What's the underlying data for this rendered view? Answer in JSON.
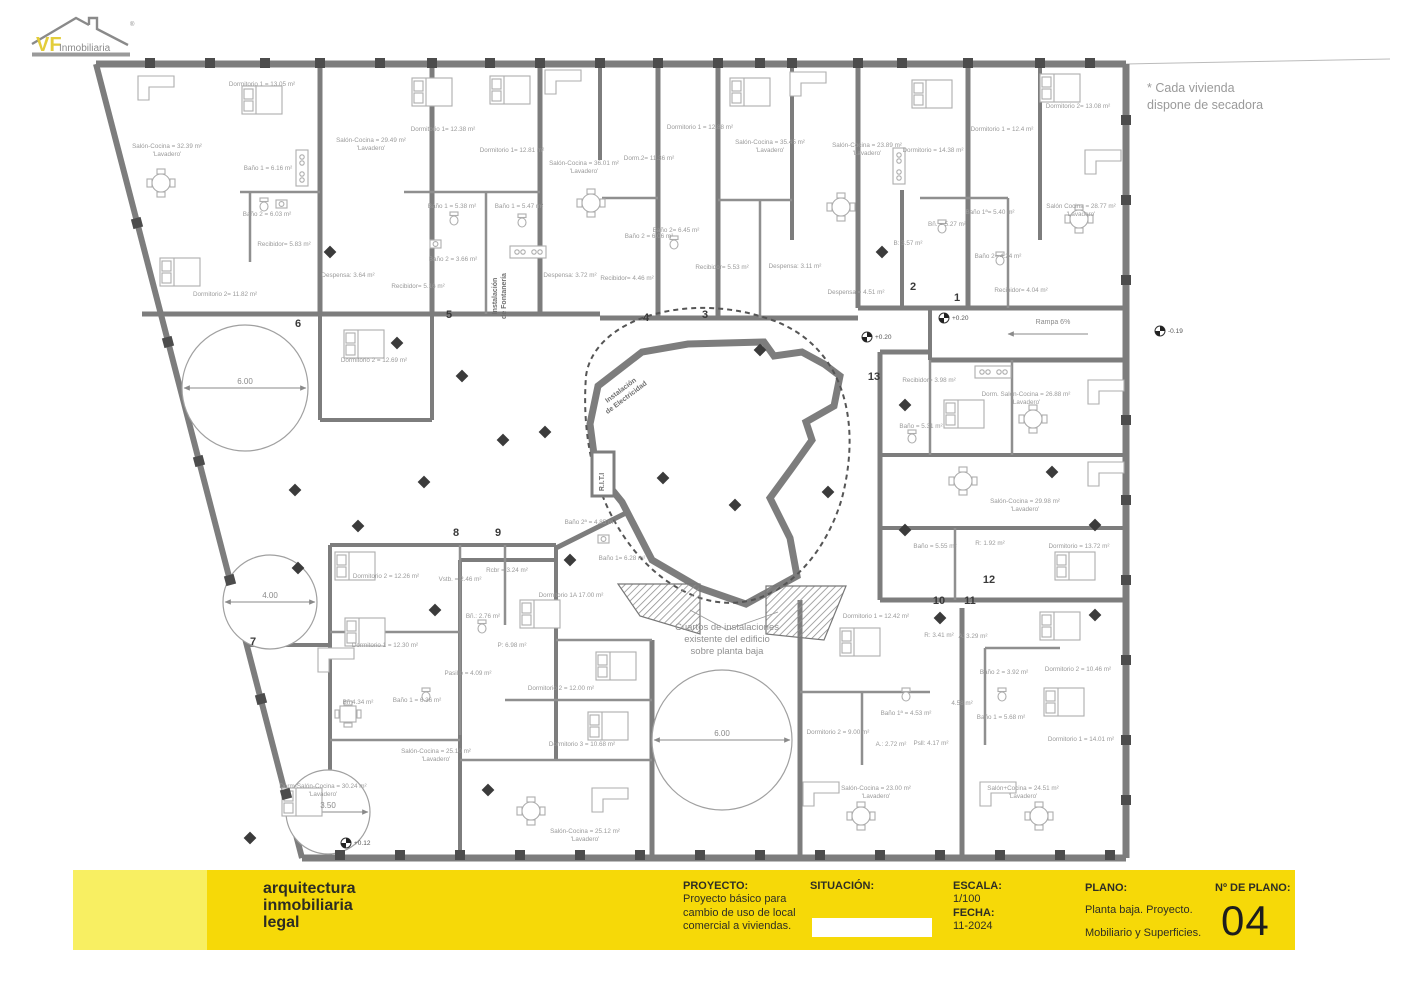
{
  "logo": {
    "vf": "VF",
    "rest": "Inmobiliaria",
    "reg": "®"
  },
  "note": {
    "line1": "* Cada vivienda",
    "line2": "dispone de secadora"
  },
  "title_block": {
    "company_lines": [
      "arquitectura",
      "inmobiliaria",
      "legal"
    ],
    "proyecto_label": "PROYECTO:",
    "proyecto_lines": [
      "Proyecto básico para",
      "cambio de uso de local",
      "comercial a viviendas."
    ],
    "situacion_label": "SITUACIÓN:",
    "escala_label": "ESCALA:",
    "escala_value": "1/100",
    "fecha_label": "FECHA:",
    "fecha_value": "11-2024",
    "plano_label": "PLANO:",
    "plano_lines": [
      "Planta baja. Proyecto.",
      "Mobiliario y Superficies."
    ],
    "num_label": "Nº DE PLANO:",
    "num_value": "04"
  },
  "plan": {
    "unit_numbers": [
      {
        "n": "6",
        "x": 298,
        "y": 327
      },
      {
        "n": "5",
        "x": 449,
        "y": 318
      },
      {
        "n": "4",
        "x": 646,
        "y": 321
      },
      {
        "n": "3",
        "x": 705,
        "y": 318
      },
      {
        "n": "2",
        "x": 913,
        "y": 290
      },
      {
        "n": "1",
        "x": 957,
        "y": 301
      },
      {
        "n": "13",
        "x": 874,
        "y": 380
      },
      {
        "n": "8",
        "x": 456,
        "y": 536
      },
      {
        "n": "9",
        "x": 498,
        "y": 536
      },
      {
        "n": "7",
        "x": 253,
        "y": 645
      },
      {
        "n": "10",
        "x": 939,
        "y": 604
      },
      {
        "n": "11",
        "x": 970,
        "y": 604
      },
      {
        "n": "12",
        "x": 989,
        "y": 583
      }
    ],
    "room_labels": [
      {
        "t": "Dormitorio 1 = 13.05 m²",
        "x": 262,
        "y": 86
      },
      {
        "t": "Salón-Cocina = 32.39 m²",
        "x": 167,
        "y": 148
      },
      {
        "t": "'Lavadero'",
        "x": 167,
        "y": 156
      },
      {
        "t": "Baño 1 = 6.16 m²",
        "x": 268,
        "y": 170
      },
      {
        "t": "Baño 2 = 6.03 m²",
        "x": 267,
        "y": 216
      },
      {
        "t": "Recibidor= 5.83 m²",
        "x": 284,
        "y": 246
      },
      {
        "t": "Dormitorio 2= 11.82 m²",
        "x": 225,
        "y": 296
      },
      {
        "t": "Salón-Cocina = 29.49 m²",
        "x": 371,
        "y": 142
      },
      {
        "t": "'Lavadero'",
        "x": 371,
        "y": 150
      },
      {
        "t": "Dormitorio 1= 12.38 m²",
        "x": 443,
        "y": 131
      },
      {
        "t": "Baño 1 = 5.38 m²",
        "x": 452,
        "y": 208
      },
      {
        "t": "Baño 2 = 3.66 m²",
        "x": 453,
        "y": 261
      },
      {
        "t": "Recibidor= 5.16 m²",
        "x": 418,
        "y": 288
      },
      {
        "t": "Dormitorio 2 = 12.69 m²",
        "x": 374,
        "y": 362
      },
      {
        "t": "Dormitorio 1= 12.81 m²",
        "x": 512,
        "y": 152
      },
      {
        "t": "Baño 1 = 5.47 m²",
        "x": 519,
        "y": 208
      },
      {
        "t": "Salón-Cocina = 36.01 m²",
        "x": 584,
        "y": 165
      },
      {
        "t": "'Lavadero'",
        "x": 584,
        "y": 173
      },
      {
        "t": "Dorm.2= 11.36 m²",
        "x": 649,
        "y": 160
      },
      {
        "t": "Despensa: 3.64 m²",
        "x": 348,
        "y": 277
      },
      {
        "t": "Despensa: 3.72 m²",
        "x": 570,
        "y": 277
      },
      {
        "t": "Recibidor= 4.46 m²",
        "x": 627,
        "y": 280
      },
      {
        "t": "Baño 2 = 6.06 m²",
        "x": 649,
        "y": 238
      },
      {
        "t": "Dormitorio 1 = 12.88 m²",
        "x": 700,
        "y": 129
      },
      {
        "t": "Salón-Cocina = 35.45 m²",
        "x": 770,
        "y": 144
      },
      {
        "t": "'Lavadero'",
        "x": 770,
        "y": 152
      },
      {
        "t": "Baño 2= 6.45 m²",
        "x": 676,
        "y": 232
      },
      {
        "t": "Recibidor= 5.53 m²",
        "x": 722,
        "y": 269
      },
      {
        "t": "Despensa: 3.11 m²",
        "x": 795,
        "y": 268
      },
      {
        "t": "Despensa = 4.51 m²",
        "x": 856,
        "y": 294
      },
      {
        "t": "Salón-Cocina = 23.89 m²",
        "x": 867,
        "y": 147
      },
      {
        "t": "'Lavadero'",
        "x": 867,
        "y": 155
      },
      {
        "t": "Dormitorio = 14.38 m²",
        "x": 933,
        "y": 152
      },
      {
        "t": "Dormitorio 1 = 12.4 m²",
        "x": 1002,
        "y": 131
      },
      {
        "t": "Dormitorio 2= 13.08 m²",
        "x": 1078,
        "y": 108
      },
      {
        "t": "Salón Cocina = 28.77 m²",
        "x": 1081,
        "y": 208
      },
      {
        "t": "'Lavadero'",
        "x": 1081,
        "y": 216
      },
      {
        "t": "Baño 1ª= 5.40 m²",
        "x": 990,
        "y": 214
      },
      {
        "t": "Bñ. = 5.27 m²",
        "x": 947,
        "y": 226
      },
      {
        "t": "B: 3.57 m²",
        "x": 908,
        "y": 245
      },
      {
        "t": "Baño 2= 4.24 m²",
        "x": 998,
        "y": 258
      },
      {
        "t": "Recibidor= 4.04 m²",
        "x": 1021,
        "y": 292
      },
      {
        "t": "Recibidor= 3.98 m²",
        "x": 929,
        "y": 382
      },
      {
        "t": "Dorm. Salón-Cocina = 26.88 m²",
        "x": 1026,
        "y": 396
      },
      {
        "t": "'Lavadero'",
        "x": 1026,
        "y": 404
      },
      {
        "t": "Baño = 5.31 m²",
        "x": 921,
        "y": 428
      },
      {
        "t": "Salón-Cocina = 29.98 m²",
        "x": 1025,
        "y": 503
      },
      {
        "t": "'Lavadero'",
        "x": 1025,
        "y": 511
      },
      {
        "t": "Baño = 5.55 m²",
        "x": 935,
        "y": 548
      },
      {
        "t": "R: 1.92 m²",
        "x": 990,
        "y": 545
      },
      {
        "t": "Dormitorio = 13.72 m²",
        "x": 1079,
        "y": 548
      },
      {
        "t": "Dormitorio 2 = 12.26 m²",
        "x": 386,
        "y": 578
      },
      {
        "t": "Dormitorio 1 = 12.30 m²",
        "x": 385,
        "y": 647
      },
      {
        "t": "Vstb. = 2.46 m²",
        "x": 460,
        "y": 581
      },
      {
        "t": "Rcbr = 3.24 m²",
        "x": 507,
        "y": 572
      },
      {
        "t": "Bñ.: 2.76 m²",
        "x": 483,
        "y": 618
      },
      {
        "t": "P: 6.98 m²",
        "x": 512,
        "y": 647
      },
      {
        "t": "Pasillo = 4.09 m²",
        "x": 468,
        "y": 675
      },
      {
        "t": "Baño 1 = 6.36 m²",
        "x": 417,
        "y": 702
      },
      {
        "t": "Bñ 4.34 m²",
        "x": 358,
        "y": 704
      },
      {
        "t": "Salón-Cocina = 25.10 m²",
        "x": 436,
        "y": 753
      },
      {
        "t": "'Lavadero'",
        "x": 436,
        "y": 761
      },
      {
        "t": "Baño 2ª = 4.85 m²",
        "x": 590,
        "y": 524
      },
      {
        "t": "Baño 1= 6.28 m²",
        "x": 622,
        "y": 560
      },
      {
        "t": "Dormitorio 1A 17.00 m²",
        "x": 571,
        "y": 597
      },
      {
        "t": "Dormitorio 2 = 12.00 m²",
        "x": 561,
        "y": 690
      },
      {
        "t": "Dormitorio 3 = 10.68 m²",
        "x": 582,
        "y": 746
      },
      {
        "t": "Salón-Cocina = 25.12 m²",
        "x": 585,
        "y": 833
      },
      {
        "t": "'Lavadero'",
        "x": 585,
        "y": 841
      },
      {
        "t": "Dorm-Salón-Cocina = 30.24 m²",
        "x": 323,
        "y": 788
      },
      {
        "t": "'Lavadero'",
        "x": 323,
        "y": 796
      },
      {
        "t": "Dormitorio 1 = 12.42 m²",
        "x": 876,
        "y": 618
      },
      {
        "t": "R: 3.41 m²",
        "x": 939,
        "y": 637
      },
      {
        "t": "A: 3.29 m²",
        "x": 973,
        "y": 638
      },
      {
        "t": "Baño 1ª = 4.53 m²",
        "x": 906,
        "y": 715
      },
      {
        "t": "Dormitorio 2 = 9.00 m²",
        "x": 838,
        "y": 734
      },
      {
        "t": "A.: 2.72 m²",
        "x": 891,
        "y": 746
      },
      {
        "t": "Psll: 4.17 m²",
        "x": 931,
        "y": 745
      },
      {
        "t": "Salón-Cocina = 23.00 m²",
        "x": 876,
        "y": 790
      },
      {
        "t": "'Lavadero'",
        "x": 876,
        "y": 798
      },
      {
        "t": "Baño 2 = 3.92 m²",
        "x": 1004,
        "y": 674
      },
      {
        "t": "Baño 1 = 5.68 m²",
        "x": 1001,
        "y": 719
      },
      {
        "t": "4.58 m²",
        "x": 962,
        "y": 705
      },
      {
        "t": "Dormitorio 2 = 10.46 m²",
        "x": 1078,
        "y": 671
      },
      {
        "t": "Dormitorio 1 = 14.01 m²",
        "x": 1081,
        "y": 741
      },
      {
        "t": "Salón+Cocina = 24.51 m²",
        "x": 1023,
        "y": 790
      },
      {
        "t": "'Lavadero'",
        "x": 1023,
        "y": 798
      }
    ],
    "dimensions": [
      {
        "t": "6.00",
        "x": 245,
        "y": 384
      },
      {
        "t": "4.00",
        "x": 270,
        "y": 598
      },
      {
        "t": "3.50",
        "x": 328,
        "y": 808
      },
      {
        "t": "6.00",
        "x": 722,
        "y": 736
      }
    ],
    "central_note": [
      "Cuartos de instalaciones",
      "existente del edificio",
      "sobre planta baja"
    ],
    "rotated_labels": [
      {
        "lines": [
          "Instalación",
          "de Fontanería"
        ],
        "x": 497,
        "y": 296,
        "rot": -90
      },
      {
        "lines": [
          "Instalación",
          "de Electricidad"
        ],
        "x": 622,
        "y": 392,
        "rot": -37
      },
      {
        "lines": [
          "R.I.T.I"
        ],
        "x": 604,
        "y": 482,
        "rot": -90
      }
    ],
    "ramp_label": "Rampa 6%",
    "elevations": [
      {
        "t": "+0.20",
        "x": 944,
        "y": 318
      },
      {
        "t": "+0.20",
        "x": 867,
        "y": 337
      },
      {
        "t": "-0.19",
        "x": 1160,
        "y": 331
      },
      {
        "t": "+0.12",
        "x": 346,
        "y": 843
      }
    ]
  },
  "colors": {
    "bar_yellow": "#f6d908",
    "bar_light_yellow": "#f8ef62",
    "wall_gray": "#7d7d7d",
    "pier_dark": "#4c4c4c",
    "label_gray": "#9a9a9a",
    "logo_yellow": "#e3cd3a"
  }
}
